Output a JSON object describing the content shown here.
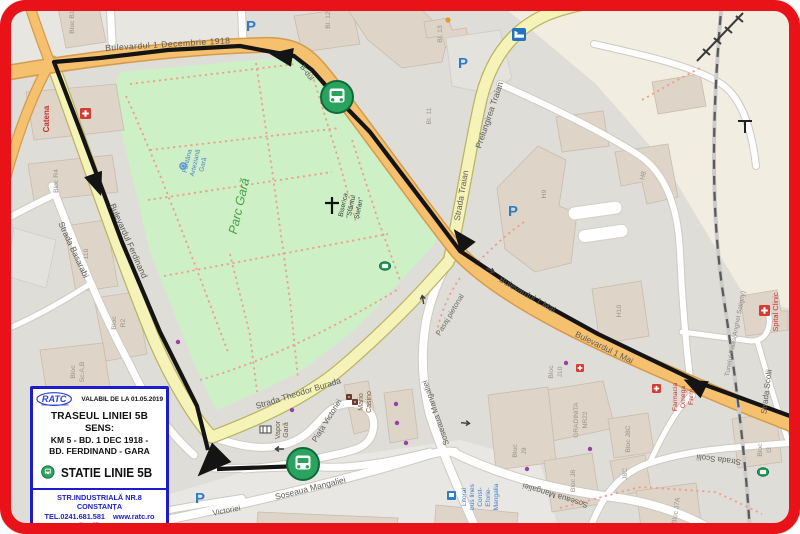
{
  "legend": {
    "logo_text": "RATC",
    "valid_label": "VALABIL DE LA 01.05.2019",
    "title": "TRASEUL LINIEI 5B",
    "sens_label": "SENS:",
    "route_line1": "KM 5  - BD. 1 DEC 1918  -",
    "route_line2": "BD. FERDINAND  - GARA",
    "station_label": "STATIE LINIE 5B",
    "address": "STR.INDUSTRIALĂ NR.8 CONSTANȚA",
    "phone": "TEL.0241.681.581",
    "website": "www.ratc.ro",
    "email": "e-mail: office@ratc.ro"
  },
  "streets": {
    "bd_1_decembrie": "Bulevardul 1 Decembrie 1918",
    "bdul_short": "B-dul",
    "strada_traian": "Strada Traian",
    "prelungirea_traian": "Prelungirea Traian",
    "bd_1_mai_a": "Bulevardul 1 Mai",
    "bd_1_mai_b": "Bulevardul 1 Mai",
    "bd_ferdinand": "Bulevardul Ferdinand",
    "strada_basarabi": "Strada Basarabi",
    "strada_theodor_burada": "Strada Theodor Burada",
    "soseaua_mangaliei_w": "Soseaua Mangaliei",
    "soseaua_mangaliei_s": "Soseaua Mangaliei",
    "soseaua_mangaliei_e": "Soseaua Mangaliei",
    "piata_victoriei": "Piața Victoriei",
    "victoriei": "Victoriei",
    "pasaj_pietonal": "Pasaj pietonal",
    "strada_scolii_a": "Strada Scolii",
    "strada_scolii_b": "Strada Scolii",
    "tunelul_palas": "Tunelul Palas(Anghel Saligny)"
  },
  "places": {
    "parc_gara": "Parc Gară",
    "fantana_line1": "Fântâna",
    "fantana_line2": "Arteziană",
    "fantana_line3": "Gară",
    "biserica_line1": "Biserica",
    "biserica_line2": "\"Sfântul",
    "biserica_line3": "Ștefan\"",
    "catena": "Catena",
    "spital_clinic": "Spital Clinic",
    "mario_line1": "Mario",
    "mario_line2": "Casino",
    "vapor_line1": "Vapor",
    "vapor_line2": "Gară",
    "farmacia_line1": "Farmacia",
    "farmacia_line2": "Omega",
    "farmacia_line3": "Farm",
    "litoral_line1": "Litoral",
    "litoral_line2": "bus lines",
    "litoral_line3": "Const-",
    "litoral_line4": "Eforie-",
    "litoral_line5": "Mangalia",
    "gradinita_line1": "GRADINITA",
    "gradinita_line2": "NR22"
  },
  "buildings": {
    "bloc_b1": "Bloc B1",
    "bl_12": "Bl. 12",
    "bl_13": "Bl. 13",
    "bl_11": "Bl. 11",
    "bloc_r4": "Bloc R4",
    "n110": "110",
    "bloc": "Bloc",
    "r2": "R2",
    "sc_ab": "Sc.A,B",
    "h9": "H9",
    "h8": "H8",
    "h10": "H10",
    "j10": "J10",
    "j9": "J9",
    "bloc_j8c": "Bloc J8C",
    "j8c": "J8C",
    "bloc_j8": "Bloc J8",
    "bloc_j7a": "Bloc J7A",
    "i3": "I3"
  },
  "icons": {
    "parking": "P"
  },
  "colors": {
    "frame_red": "#e91219",
    "legend_blue": "#1c1ccd",
    "bus_green": "#2aa35e",
    "park_green": "#cdf0c6",
    "road_orange": "#f6c16e",
    "road_yellow": "#f6f3b8",
    "route_black": "#141414",
    "parking_blue": "#2e7bc6",
    "poi_red": "#c8312f"
  }
}
